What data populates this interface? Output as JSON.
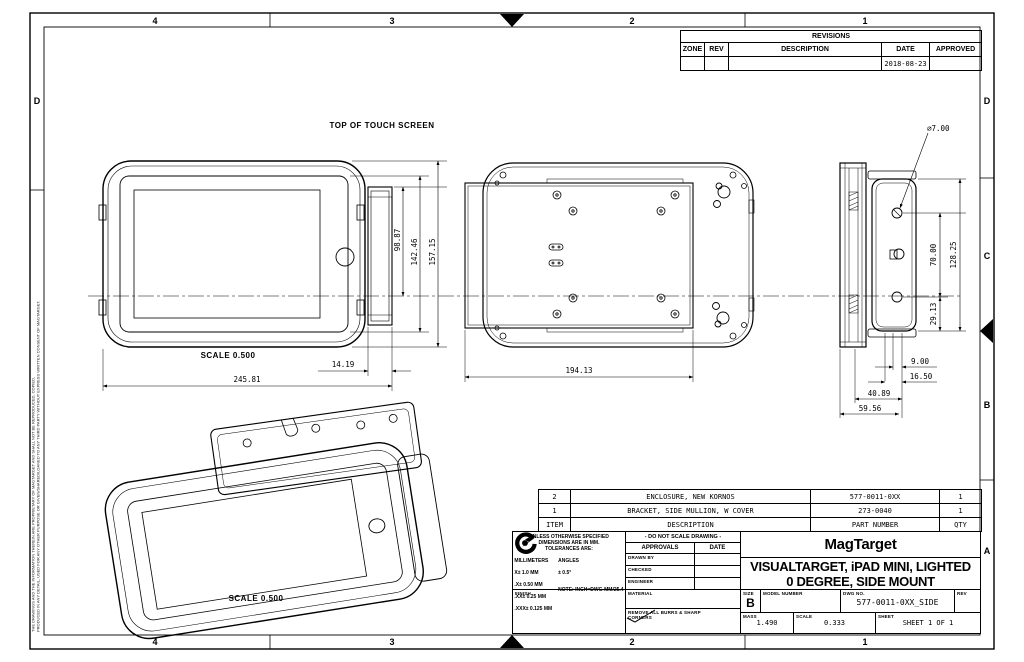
{
  "sheet": {
    "zones_top": [
      "4",
      "3",
      "2",
      "1"
    ],
    "zones_bottom": [
      "4",
      "3",
      "2",
      "1"
    ],
    "zones_right": [
      "D",
      "C",
      "B",
      "A"
    ],
    "zone_left": "D",
    "proprietary_line1": "THE DRAWINGS AND THE INFORMATION THEREIN ARE PROPRIETARY OF MAGTARGET AND SHALL NOT BE REPRODUCED, COPIED,",
    "proprietary_line2": "PRODUCED IN ANY DETAIL, USED FOR ANY OTHER PURPOSE OR GIVEN/SHARED/LOANED TO ANY THIRD PARTY WITHOUT EXPRESS WRITTEN CONSENT OF MAGTARGET."
  },
  "revisions": {
    "title": "REVISIONS",
    "columns": [
      "ZONE",
      "REV",
      "DESCRIPTION",
      "DATE",
      "APPROVED"
    ],
    "rows": [
      {
        "zone": "",
        "rev": "",
        "description": "",
        "date": "2018-08-23",
        "approved": ""
      }
    ]
  },
  "views": {
    "top_note": "TOP OF TOUCH SCREEN",
    "front": {
      "scale_label": "SCALE 0.500",
      "dim_bracket_to_center": "98.87",
      "dim_bezel_height": "142.46",
      "dim_overall_height": "157.15",
      "dim_bracket_offset": "14.19",
      "dim_overall_width": "245.81"
    },
    "back": {
      "dim_plate_width": "194.13"
    },
    "side": {
      "dim_hole_dia": "⌀7.00",
      "dim_hole_spacing": "70.00",
      "dim_cover_height": "128.25",
      "dim_hole_to_bottom": "29.13",
      "dim_a": "9.00",
      "dim_b": "16.50",
      "dim_c": "40.89",
      "dim_d": "59.56"
    },
    "iso": {
      "scale_label": "SCALE 0.500"
    }
  },
  "parts_list": {
    "columns": [
      "ITEM",
      "DESCRIPTION",
      "PART NUMBER",
      "QTY"
    ],
    "rows": [
      {
        "item": "2",
        "description": "ENCLOSURE, NEW KORNOS",
        "part": "577-0011-0XX",
        "qty": "1"
      },
      {
        "item": "1",
        "description": "BRACKET, SIDE MULLION, W COVER",
        "part": "273-0040",
        "qty": "1"
      }
    ]
  },
  "title_block": {
    "tolerances": {
      "l1": "UNLESS OTHERWISE SPECIFIED",
      "l2": "DIMENSIONS ARE IN MM.",
      "l3": "TOLERANCES ARE:",
      "col_mm": "MILLIMETERS",
      "col_ang": "ANGLES",
      "mm1": "X±  1.0   MM",
      "mm2": ".X±  0.50  MM",
      "mm3": ".XX±  0.25  MM",
      "mm4": ".XXX± 0.125 MM",
      "ang1": "± 0.5°",
      "note": "NOTE: INCH=DWG-MM/25.4"
    },
    "finish_label": "FINISH",
    "do_not_scale": "- DO NOT SCALE DRAWING -",
    "approvals_label": "APPROVALS",
    "date_label": "DATE",
    "row_drawn": "DRAWN BY",
    "row_checked": "CHECKED",
    "row_engineer": "ENGINEER",
    "material_label": "MATERIAL",
    "deburr_note": "REMOVE ALL BURRS & SHARP CORNERS",
    "company": "MagTarget",
    "title_line1": "VISUALTARGET, iPAD MINI, LIGHTED",
    "title_line2": "0 DEGREE, SIDE MOUNT",
    "size_label": "SIZE",
    "size_value": "B",
    "model_label": "MODEL NUMBER",
    "model_value": "",
    "dwg_label": "DWG NO.",
    "dwg_value": "577-0011-0XX_SIDE",
    "rev_label": "REV",
    "rev_value": "",
    "mass_label": "MASS",
    "mass_value": "1.490",
    "scale_label": "SCALE",
    "scale_value": "0.333",
    "sheet_label": "SHEET",
    "sheet_value": "SHEET 1 OF 1"
  }
}
